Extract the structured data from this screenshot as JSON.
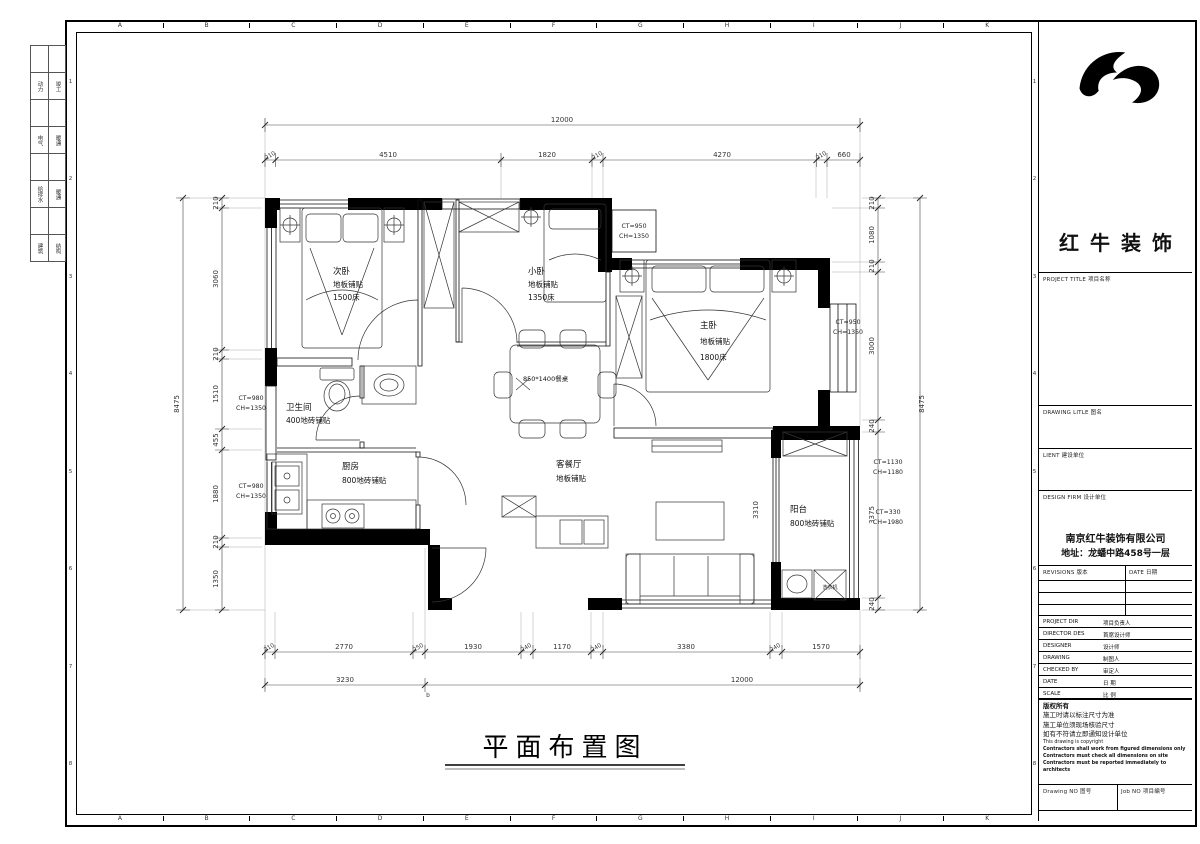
{
  "sheet": {
    "grid_letters": [
      "A",
      "B",
      "C",
      "D",
      "E",
      "F",
      "G",
      "H",
      "I",
      "J",
      "K"
    ],
    "grid_numbers": [
      "1",
      "2",
      "3",
      "4",
      "5",
      "6",
      "7",
      "8"
    ],
    "discipline_rows": [
      [
        "动力",
        "竣工"
      ],
      [
        "电气",
        "暖通"
      ],
      [
        "给排水",
        "暖通"
      ],
      [
        "建筑",
        "结构"
      ]
    ],
    "drawing_title": "平面布置图"
  },
  "plan": {
    "rooms": {
      "secondary_bedroom": {
        "name": "次卧",
        "finish": "地板铺贴",
        "note": "1500床"
      },
      "small_bedroom": {
        "name": "小卧",
        "finish": "地板铺贴",
        "note": "1350床"
      },
      "master_bedroom": {
        "name": "主卧",
        "finish": "地板铺贴",
        "note": "1800床"
      },
      "bathroom": {
        "name": "卫生间",
        "finish": "400地砖铺贴"
      },
      "kitchen": {
        "name": "厨房",
        "finish": "800地砖铺贴"
      },
      "living_dining": {
        "name": "客餐厅",
        "finish": "地板铺贴"
      },
      "balcony": {
        "name": "阳台",
        "finish": "800地砖铺贴"
      }
    },
    "annotations": {
      "dining_table": "850*1400餐桌",
      "washer": "洗衣机",
      "opening_dim": "3310",
      "marker_b": "b",
      "ct_top_bay": {
        "l1": "CT=950",
        "l2": "CH=1350"
      },
      "ct_right_bay": {
        "l1": "CT=950",
        "l2": "CH=1350"
      },
      "ct_bathroom": {
        "l1": "CT=980",
        "l2": "CH=1350"
      },
      "ct_kitchen": {
        "l1": "CT=980",
        "l2": "CH=1350"
      },
      "ct_balcony_top": {
        "l1": "CT=1130",
        "l2": "CH=1180"
      },
      "ct_balcony_bottom": {
        "l1": "CT=330",
        "l2": "CH=1980"
      }
    },
    "dims": {
      "top_total": "12000",
      "top_row": [
        "210",
        "4510",
        "1820",
        "210",
        "4270",
        "210",
        "660"
      ],
      "bottom_row": [
        "210",
        "2770",
        "250",
        "1930",
        "240",
        "1170",
        "240",
        "3380",
        "240",
        "1570"
      ],
      "bottom_sub": "3230",
      "bottom_total": "12000",
      "left_row": [
        "210",
        "3060",
        "210",
        "1510",
        "455",
        "1880",
        "210",
        "1350"
      ],
      "left_total": "8475",
      "right_row": [
        "210",
        "1080",
        "210",
        "3000",
        "240",
        "3375",
        "240"
      ],
      "right_total": "8475"
    }
  },
  "titleblock": {
    "brand": "红牛装饰",
    "project_title_label": "PROJECT TITLE  项目名称",
    "drawing_title_label": "DRAWING LITLE  图名",
    "client_label": "LIENT  建设单位",
    "design_firm_label": "DESIGN FIRM  设计单位",
    "company": "南京红牛装饰有限公司",
    "address": "地址：龙蟠中路458号一层",
    "revisions_label": "REVISIONS  版本",
    "date_col_label": "DATE  日期",
    "rows": [
      {
        "en": "PROJECT DIR",
        "zh": "项目负责人"
      },
      {
        "en": "DIRECTOR DES",
        "zh": "首席设计师"
      },
      {
        "en": "DESIGNER",
        "zh": "设计师"
      },
      {
        "en": "DRAWING",
        "zh": "制图人"
      },
      {
        "en": "CHECKED BY",
        "zh": "审定人"
      },
      {
        "en": "DATE",
        "zh": "日  期"
      },
      {
        "en": "SCALE",
        "zh": "比  例"
      }
    ],
    "copyright": {
      "zh": [
        "版权所有",
        "施工时请以标注尺寸为准",
        "施工单位须现场核验尺寸",
        "如有不符请立即通知设计单位"
      ],
      "en": [
        "This drawing is copyright",
        "Contractors shall work from figured dimensions only",
        "Contractors must check all dimensions on site",
        "Contractors must be reported immediately to architects"
      ]
    },
    "drawing_no_label": "Drawing NO  图号",
    "job_no_label": "Job NO  项目编号"
  }
}
